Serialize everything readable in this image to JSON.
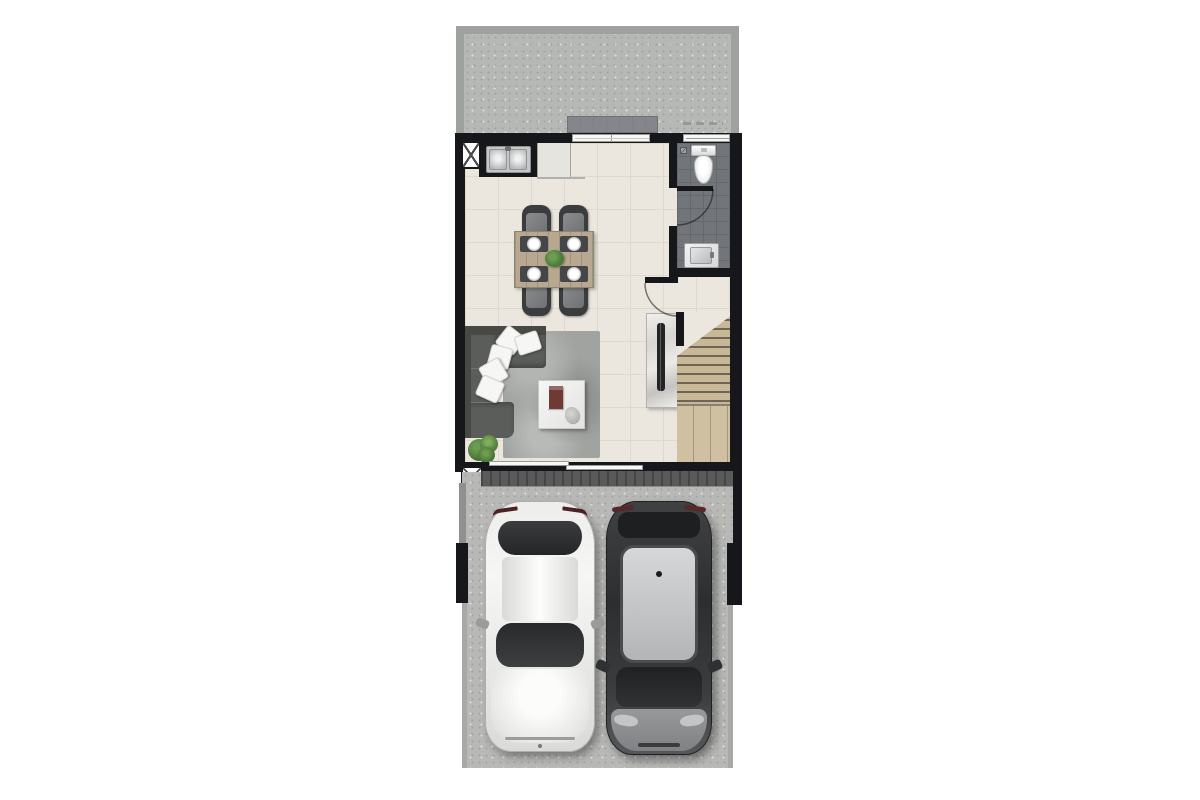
{
  "document": {
    "kind": "floor-plan",
    "view": "top-down",
    "visible_text": ""
  },
  "colors": {
    "wall": "#16171a",
    "floor": "#ebe7df",
    "floorGrid": "#ded9ce",
    "terrace": "#b6b8b5",
    "terraceFrame": "#9fa19e",
    "stoop": "#84868b",
    "bathFloor": "#72757a",
    "bathGrid": "#65686d",
    "fixtureWhite": "#f2f3f3",
    "wood": "#c9b897",
    "woodDark": "#6e6557",
    "woodLight": "#cec0a0",
    "rug": "#a1a3a1",
    "sofa": "#5b5d5b",
    "sofaDark": "#474947",
    "pillow": "#f6f6f4",
    "tableWood": "#b7a88f",
    "chair": "#3a3c3e",
    "chairCushion": "#7c7e80",
    "mat": "#44464a",
    "plant": "#4e7a3a",
    "concrete": "#b8b8b6",
    "band": "#595a59",
    "carWhite": "#efefed",
    "glass": "#2a2c2e",
    "suvBody": "#35373a",
    "suvRoof": "#c9cacc",
    "suvHood": "#8f9193",
    "tv": "#232426",
    "marble": "#e7e5e1",
    "doorWhite": "#f7f7f5"
  },
  "counts": {
    "dining_chairs": 4,
    "dining_plates": 4,
    "sofa_pillows": 5,
    "cars": 2,
    "bathrooms": 1
  },
  "legend": [
    {
      "id": "front-terrace",
      "label": "concrete front terrace"
    },
    {
      "id": "entry-step",
      "label": "recessed entry step"
    },
    {
      "id": "sliding-door-top",
      "label": "sliding glass door to terrace"
    },
    {
      "id": "service-shaft",
      "label": "shaft symbol (crossed box)"
    },
    {
      "id": "kitchen-sink",
      "label": "double-bowl kitchen sink"
    },
    {
      "id": "kitchen-counter",
      "label": "kitchen counter"
    },
    {
      "id": "dining-set",
      "label": "dining table with 4 chairs and plates"
    },
    {
      "id": "bathroom",
      "label": "bathroom with toilet and vanity"
    },
    {
      "id": "toilet",
      "label": "toilet"
    },
    {
      "id": "vanity-sink",
      "label": "vanity sink"
    },
    {
      "id": "door-arc",
      "label": "door swing arc"
    },
    {
      "id": "tv-console",
      "label": "marble TV console with TV"
    },
    {
      "id": "staircase",
      "label": "wooden staircase"
    },
    {
      "id": "sofa",
      "label": "L-shaped sofa with pillows"
    },
    {
      "id": "rug",
      "label": "gray area rug"
    },
    {
      "id": "coffee-table",
      "label": "coffee table with book"
    },
    {
      "id": "plant",
      "label": "potted plant"
    },
    {
      "id": "sliding-door-bottom",
      "label": "sliding glass door to carport"
    },
    {
      "id": "carport",
      "label": "two-car carport"
    },
    {
      "id": "car-white",
      "label": "white sedan"
    },
    {
      "id": "car-dark",
      "label": "dark SUV"
    }
  ]
}
